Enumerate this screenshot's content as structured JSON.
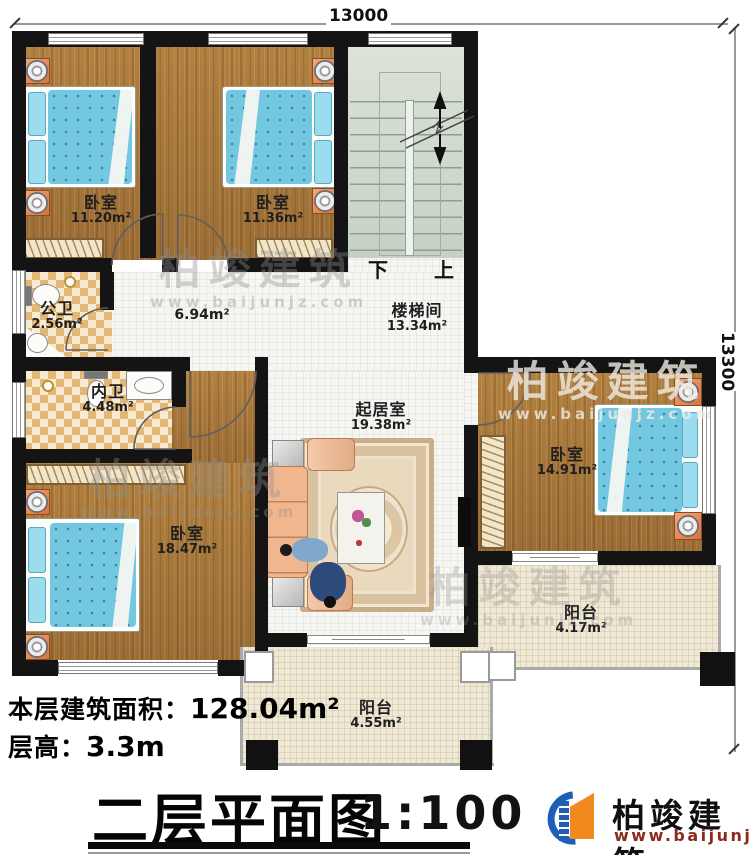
{
  "dimensions": {
    "top": "13000",
    "right": "13300"
  },
  "rooms": {
    "bedroom_tl": {
      "name": "卧室",
      "area": "11.20m²"
    },
    "bedroom_tm": {
      "name": "卧室",
      "area": "11.36m²"
    },
    "stairwell": {
      "name": "楼梯间",
      "area": "13.34m²"
    },
    "hallway": {
      "area": "6.94m²"
    },
    "public_bath": {
      "name": "公卫",
      "area": "2.56m²"
    },
    "private_bath": {
      "name": "内卫",
      "area": "4.48m²"
    },
    "living": {
      "name": "起居室",
      "area": "19.38m²"
    },
    "bedroom_bl": {
      "name": "卧室",
      "area": "18.47m²"
    },
    "bedroom_r": {
      "name": "卧室",
      "area": "14.91m²"
    },
    "balcony_s": {
      "name": "阳台",
      "area": "4.55m²"
    },
    "balcony_e": {
      "name": "阳台",
      "area": "4.17m²"
    }
  },
  "stairs": {
    "down": "下",
    "up": "上"
  },
  "footer": {
    "area_label": "本层建筑面积：",
    "area_value": "128.04m²",
    "height_label": "层高：",
    "height_value": "3.3m"
  },
  "title": {
    "name": "二层平面图",
    "scale": "1:100"
  },
  "brand": {
    "name": "柏竣建筑",
    "url": "www.baijunjz.com"
  },
  "watermark": {
    "name": "柏竣建筑",
    "url": "www.baijunjz.com"
  },
  "colors": {
    "wall": "#141414",
    "logo_blue": "#1d5fb8",
    "logo_orange": "#f0891e",
    "url_red": "#8a2b1b",
    "bed": "#74c7e0"
  }
}
